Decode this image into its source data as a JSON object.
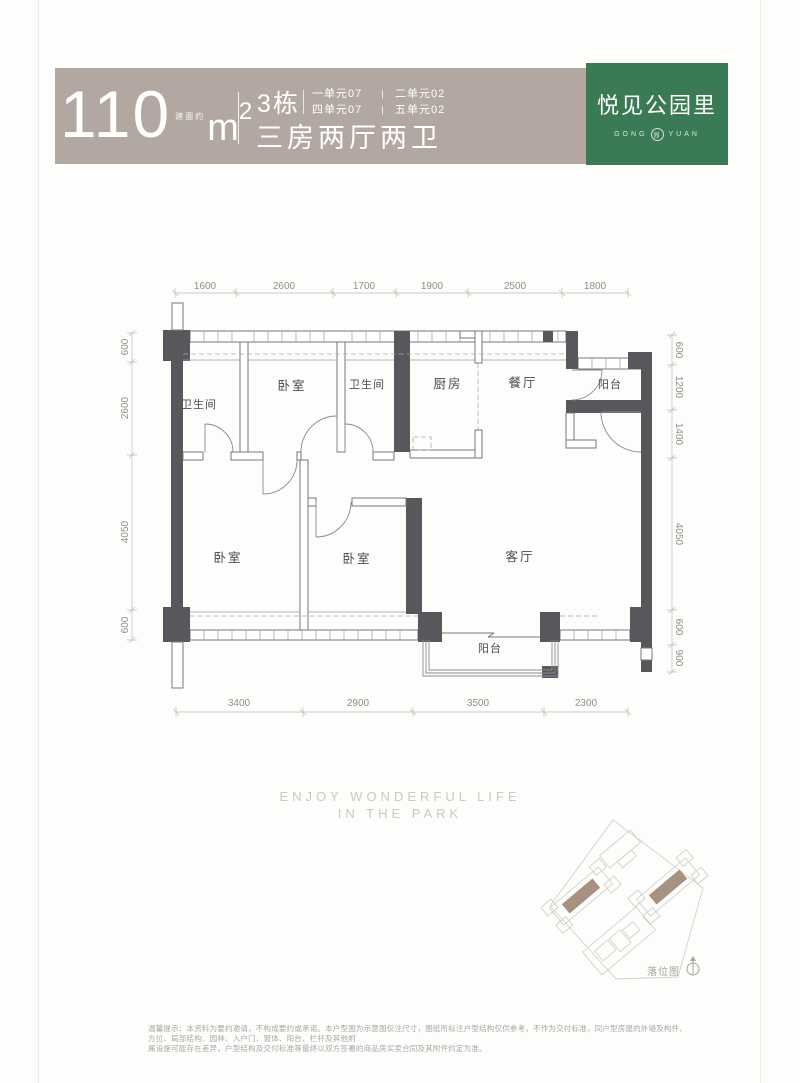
{
  "header": {
    "area_value": "110",
    "area_note": "建面约",
    "area_unit": "m",
    "area_sup": "2",
    "building": "3栋",
    "units": [
      "一单元07",
      "二单元02",
      "四单元07",
      "五单元02"
    ],
    "layout": "三房两厅两卫",
    "brand": {
      "name": "悦见公园里",
      "latin_left": "GONG",
      "latin_right": "YUAN",
      "emblem": "园"
    }
  },
  "plan": {
    "rooms": [
      {
        "label": "卫生间"
      },
      {
        "label": "卧室"
      },
      {
        "label": "卫生间"
      },
      {
        "label": "厨房"
      },
      {
        "label": "餐厅"
      },
      {
        "label": "阳台"
      },
      {
        "label": "卧室"
      },
      {
        "label": "卧室"
      },
      {
        "label": "客厅"
      },
      {
        "label": "阳台"
      }
    ],
    "dims": {
      "top": [
        "1600",
        "2600",
        "1700",
        "1900",
        "2500",
        "1800"
      ],
      "left": [
        "600",
        "2600",
        "4050",
        "600"
      ],
      "right": [
        "600",
        "1200",
        "1400",
        "4050",
        "600",
        "900"
      ],
      "bottom": [
        "3400",
        "2900",
        "3500",
        "2300"
      ]
    }
  },
  "tagline": {
    "line1": "ENJOY WONDERFUL LIFE",
    "line2": "IN THE PARK"
  },
  "siteplan": {
    "label": "落位图"
  },
  "footer": {
    "line1": "温馨提示：本资料为要约邀请，不构成要约或承诺。本户型图为示意图仅注尺寸，图纸所标注户型结构仅供参考，不作为交付标准，同户型房屋的外墙及构件、方位、局部结构、园林、入户门、窗体、阳台、栏杆及其他附",
    "line2": "属设施可能存在差异，户型结构及交付标准等最终以双方签署的商品房买卖合同及其附件约定为准。"
  }
}
